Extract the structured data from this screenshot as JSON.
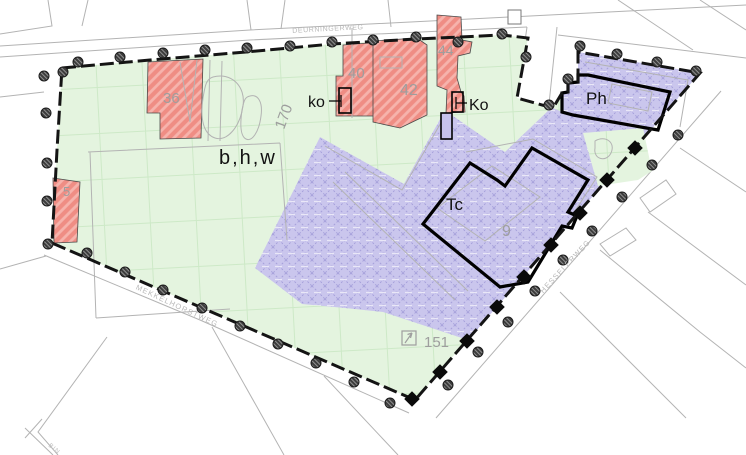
{
  "map": {
    "streets": {
      "deurningerweg": "DEURNINGERWEG",
      "mekkelhorstweg": "MEKKELHORSTWEG",
      "hesselerweg": "HESSELERWEG",
      "bottom_left_partial": "BIN"
    },
    "zone_labels": {
      "mixed_use": "b,h,w",
      "tc": "Tc",
      "ph": "Ph",
      "ko_small": "ko",
      "ko_large": "Ko"
    },
    "parcel_numbers": {
      "n5": "5",
      "n9": "9",
      "n36": "36",
      "n40": "40",
      "n42": "42",
      "n44": "44",
      "n151": "151",
      "n170": "170"
    },
    "colors": {
      "zone_green": "#e4f4df",
      "zone_red": "#ef8d84",
      "zone_purple": "#cac6ed",
      "boundary_black": "#141414",
      "cadastral_grey": "#b3b3b3",
      "label_grey": "#9e9e9e"
    }
  }
}
